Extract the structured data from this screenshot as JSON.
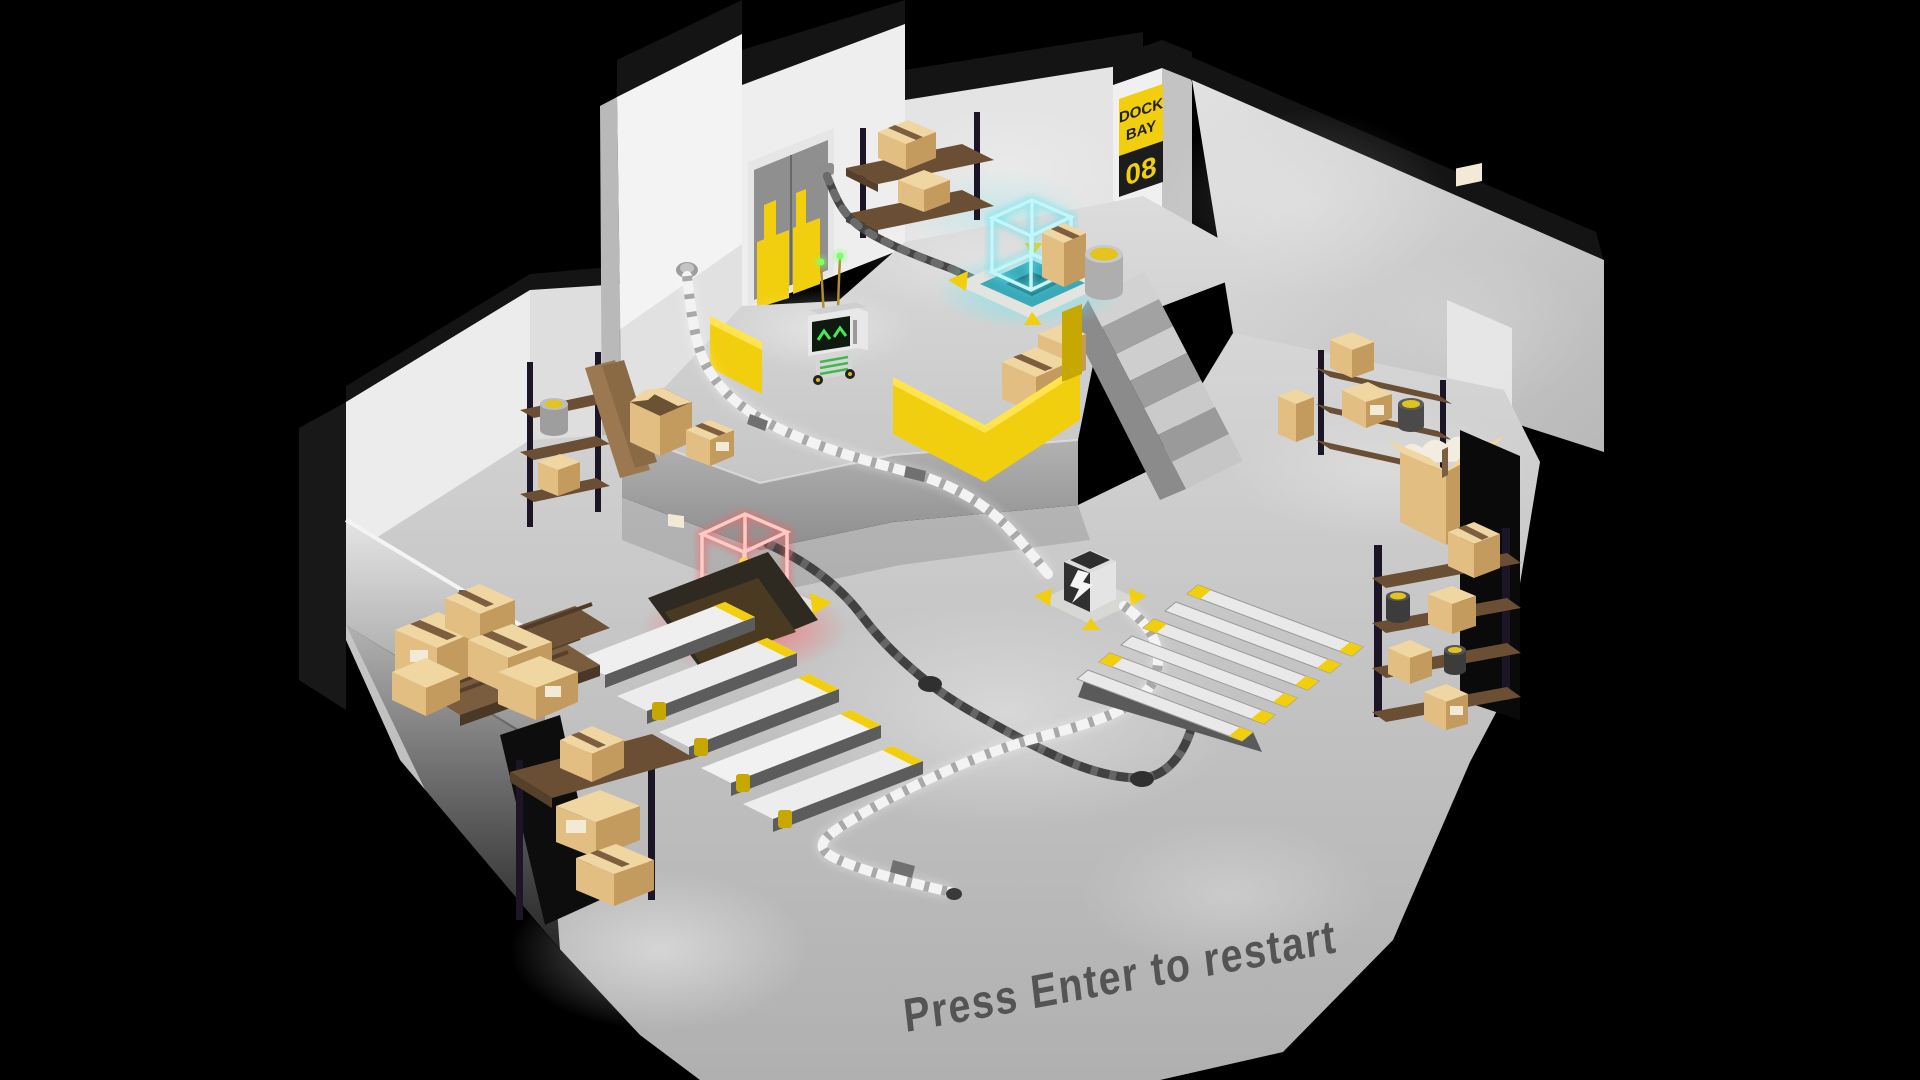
{
  "hud": {
    "restart_hint": "Press Enter to restart"
  },
  "dock_sign": {
    "line1": "DOCK",
    "line2": "BAY",
    "number": "08"
  },
  "palette": {
    "background": "#000000",
    "accent_yellow": "#F2CF0E",
    "hologram_blue": "#7FEAF2",
    "hologram_red": "#FF7A7A",
    "floor_gray": "#C9C9C9",
    "wall_white": "#F0F0F0",
    "cardboard_tan": "#E2BE82",
    "robot_eye_green": "#46E85A"
  },
  "scene_objects": [
    "robot",
    "hologram-cube-blue",
    "hologram-cube-red",
    "power-node",
    "dock-door",
    "stairs",
    "conveyor-planks",
    "floor-ramp",
    "shelving-units",
    "cardboard-boxes",
    "fire-extinguisher",
    "white-cable",
    "dark-cable",
    "yellow-barriers",
    "barrels"
  ]
}
